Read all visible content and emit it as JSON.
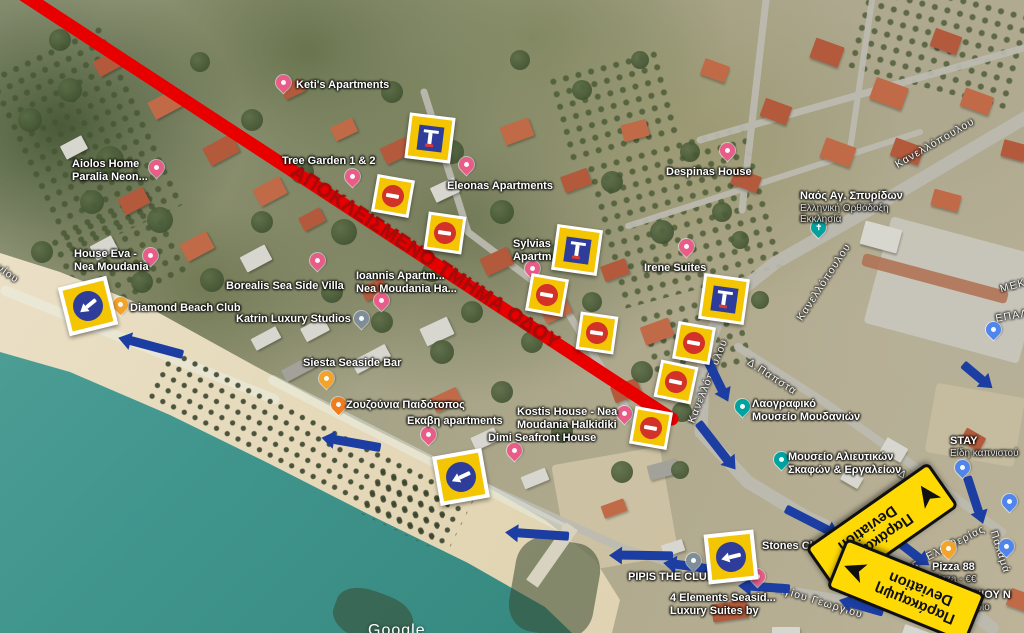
{
  "map": {
    "closed_road_text": "ΑΠΟΚΛΕΙΣΜΕΝΟ ΤΜΗΜΑ ΟΔΟΥ",
    "watermark": "Google",
    "colors": {
      "closed_line": "#e80000",
      "closed_text": "#a50b0b",
      "sign_yellow": "#f3c503",
      "sign_blue": "#2e3d99",
      "no_entry_red": "#d23227",
      "detour_arrow": "#1c3ea2",
      "deviation_yellow": "#ffd903",
      "sea": "#3f948c"
    },
    "places": [
      {
        "name": "ketis-apartments",
        "lines": [
          "Keti's Apartments"
        ],
        "lx": 296,
        "ly": 79,
        "marker": {
          "type": "pink",
          "x": 283,
          "y": 90
        }
      },
      {
        "name": "aiolos-home",
        "lines": [
          "Aiolos Home",
          "Paralia Neon..."
        ],
        "lx": 72,
        "ly": 158,
        "marker": {
          "type": "pink",
          "x": 156,
          "y": 175
        }
      },
      {
        "name": "house-eva",
        "lines": [
          "House Eva -",
          "Nea Moudania"
        ],
        "lx": 74,
        "ly": 248,
        "marker": {
          "type": "pink",
          "x": 150,
          "y": 263
        }
      },
      {
        "name": "borealis-villa",
        "lines": [
          "Borealis Sea Side Villa"
        ],
        "lx": 226,
        "ly": 280,
        "marker": {
          "type": "pink",
          "x": 317,
          "y": 268
        }
      },
      {
        "name": "tree-garden",
        "lines": [
          "Tree Garden 1 & 2"
        ],
        "lx": 282,
        "ly": 155,
        "marker": {
          "type": "pink",
          "x": 352,
          "y": 184
        }
      },
      {
        "name": "eleonas-apartments",
        "lines": [
          "Eleonas Apartments"
        ],
        "lx": 447,
        "ly": 180,
        "marker": {
          "type": "pink",
          "x": 466,
          "y": 172
        }
      },
      {
        "name": "despinas-house",
        "lines": [
          "Despinas House"
        ],
        "lx": 666,
        "ly": 166,
        "marker": {
          "type": "pink",
          "x": 727,
          "y": 158
        }
      },
      {
        "name": "sylvias-apartments",
        "lines": [
          "Sylvias",
          "Apartm..."
        ],
        "lx": 513,
        "ly": 238,
        "marker": {
          "type": "pink",
          "x": 532,
          "y": 276
        }
      },
      {
        "name": "irene-suites",
        "lines": [
          "Irene Suites"
        ],
        "lx": 644,
        "ly": 262,
        "marker": {
          "type": "pink",
          "x": 686,
          "y": 254
        }
      },
      {
        "name": "ioannis-apartments",
        "lines": [
          "Ioannis Apartm...",
          "Nea Moudania Ha..."
        ],
        "lx": 356,
        "ly": 270,
        "marker": {
          "type": "pink",
          "x": 381,
          "y": 308
        }
      },
      {
        "name": "katrin-studios",
        "lines": [
          "Katrin Luxury Studios"
        ],
        "lx": 236,
        "ly": 313,
        "marker": {
          "type": "gray",
          "x": 361,
          "y": 326
        }
      },
      {
        "name": "diamond-beach-club",
        "lines": [
          "Diamond Beach Club"
        ],
        "lx": 130,
        "ly": 302,
        "marker": {
          "type": "yellow",
          "x": 120,
          "y": 312
        }
      },
      {
        "name": "siesta-seaside-bar",
        "lines": [
          "Siesta Seaside Bar"
        ],
        "lx": 303,
        "ly": 357,
        "marker": {
          "type": "yellow",
          "x": 326,
          "y": 386
        }
      },
      {
        "name": "zouzounia",
        "lines": [
          "Ζουζούνια Παιδότοπος"
        ],
        "lx": 346,
        "ly": 399,
        "marker": {
          "type": "orange",
          "x": 338,
          "y": 412
        }
      },
      {
        "name": "ekavi-apartments",
        "lines": [
          "Εκαβη apartments"
        ],
        "lx": 407,
        "ly": 415,
        "marker": {
          "type": "pink",
          "x": 428,
          "y": 442
        }
      },
      {
        "name": "kostis-house",
        "lines": [
          "Kostis House - Nea",
          "Moudania Halkidiki"
        ],
        "lx": 517,
        "ly": 406,
        "marker": {
          "type": "pink",
          "x": 624,
          "y": 421
        }
      },
      {
        "name": "dimi-seafront-house",
        "lines": [
          "Dimi Seafront House"
        ],
        "lx": 488,
        "ly": 432,
        "marker": {
          "type": "pink",
          "x": 514,
          "y": 458
        }
      },
      {
        "name": "four-elements",
        "lines": [
          "4 Elements Seasid...",
          "Luxury Suites by"
        ],
        "lx": 670,
        "ly": 592,
        "marker": {
          "type": "pink",
          "x": 757,
          "y": 584
        }
      },
      {
        "name": "pipis-the-club",
        "lines": [
          "PIPIS THE CLUB"
        ],
        "lx": 628,
        "ly": 571,
        "marker": {
          "type": "gray",
          "x": 693,
          "y": 568
        }
      },
      {
        "name": "stones-club",
        "lines": [
          "Stones Club"
        ],
        "lx": 762,
        "ly": 540,
        "marker": {
          "type": "yellow",
          "x": 831,
          "y": 550
        }
      },
      {
        "name": "pizza-88",
        "lines": [
          "Pizza 88"
        ],
        "subs": [
          "Pizza - €€"
        ],
        "lx": 932,
        "ly": 561,
        "marker": {
          "type": "yellow",
          "x": 948,
          "y": 556
        }
      },
      {
        "name": "laografiko-mouseio",
        "lines": [
          "Λαογραφικό",
          "Μουσείο Μουδανιών"
        ],
        "lx": 752,
        "ly": 398,
        "marker": {
          "type": "teal",
          "x": 742,
          "y": 414
        }
      },
      {
        "name": "mouseio-alieutikon",
        "lines": [
          "Μουσείο Αλιευτικών",
          "Σκαφών & Εργαλείων"
        ],
        "lx": 788,
        "ly": 451,
        "marker": {
          "type": "teal",
          "x": 781,
          "y": 467
        }
      },
      {
        "name": "naos-ag-spyridon",
        "lines": [
          "Ναός Αγ. Σπυρίδων"
        ],
        "subs": [
          "Ελληνική Ορθόδοξη",
          "Εκκλησία"
        ],
        "lx": 800,
        "ly": 190,
        "marker": {
          "type": "church",
          "x": 818,
          "y": 235,
          "glyph": "✝"
        }
      },
      {
        "name": "stay-shop",
        "lines": [
          "STAY"
        ],
        "subs": [
          "Είδη καπνιστού"
        ],
        "lx": 950,
        "ly": 435,
        "marker": {
          "type": "blue",
          "x": 962,
          "y": 475
        }
      },
      {
        "name": "antoniou",
        "lines": [
          "ΑΝΤΩΝΙΟΥ Ν"
        ],
        "subs": [
          "Εστιατόριο"
        ],
        "lx": 942,
        "ly": 589,
        "marker": null
      }
    ],
    "extra_markers": [
      {
        "name": "lodging-marker",
        "type": "blue",
        "x": 993,
        "y": 337
      },
      {
        "name": "shop-marker",
        "type": "blue",
        "x": 1009,
        "y": 509
      },
      {
        "name": "lodging-marker",
        "type": "blue",
        "x": 1006,
        "y": 554
      }
    ],
    "street_labels": [
      {
        "text": "Κανελλόπουλου",
        "x": 935,
        "y": 143,
        "rot": -30
      },
      {
        "text": "Κανελλόπουλου",
        "x": 824,
        "y": 282,
        "rot": -57
      },
      {
        "text": "Κανελλόπουλου",
        "x": 708,
        "y": 381,
        "rot": -68
      },
      {
        "text": "Δ.Παπστα",
        "x": 772,
        "y": 377,
        "rot": 33
      },
      {
        "text": "Δ.Παπστα",
        "x": 923,
        "y": 488,
        "rot": 33
      },
      {
        "text": "Λεωφ. Ελευθερίας",
        "x": 938,
        "y": 552,
        "rot": -27
      },
      {
        "text": "Παλαμά",
        "x": 1000,
        "y": 552,
        "rot": 72
      },
      {
        "text": "Αγίου Γεωργίου",
        "x": 820,
        "y": 602,
        "rot": 17
      },
      {
        "text": "νίου",
        "x": 8,
        "y": 274,
        "rot": 35
      },
      {
        "text": "ΜΕΚ",
        "x": 1013,
        "y": 286,
        "rot": -15
      },
      {
        "text": "ΕΠΑΛ",
        "x": 1012,
        "y": 316,
        "rot": -10
      }
    ],
    "signs": {
      "no_entry": [
        {
          "x": 393,
          "y": 196,
          "rot": 10
        },
        {
          "x": 445,
          "y": 233,
          "rot": 8
        },
        {
          "x": 547,
          "y": 295,
          "rot": 10
        },
        {
          "x": 597,
          "y": 333,
          "rot": 8
        },
        {
          "x": 694,
          "y": 343,
          "rot": 10
        },
        {
          "x": 676,
          "y": 382,
          "rot": 12
        },
        {
          "x": 651,
          "y": 428,
          "rot": 10
        }
      ],
      "dead_end": [
        {
          "x": 430,
          "y": 138,
          "rot": 7
        },
        {
          "x": 577,
          "y": 250,
          "rot": 8
        },
        {
          "x": 724,
          "y": 299,
          "rot": 8
        }
      ],
      "turn_left": [
        {
          "x": 88,
          "y": 306,
          "rot": -14,
          "arrow": -25
        },
        {
          "x": 461,
          "y": 477,
          "rot": -10,
          "arrow": -15
        },
        {
          "x": 731,
          "y": 557,
          "rot": -6,
          "arrow": -8
        }
      ]
    },
    "deviation_signs": [
      {
        "line1": "Παράκαμψη",
        "line2": "Deviation",
        "x": 882,
        "y": 527,
        "rot": 145,
        "arrow_at": "start",
        "arrow_rot": 90
      },
      {
        "line1": "Παράκαμψη",
        "line2": "Deviation",
        "x": 906,
        "y": 591,
        "rot": 202,
        "arrow_at": "end",
        "arrow_rot": 0
      }
    ],
    "detour_arrows": [
      {
        "x": 156,
        "y": 347,
        "rot": 195,
        "len": 55
      },
      {
        "x": 357,
        "y": 443,
        "rot": 190,
        "len": 48
      },
      {
        "x": 543,
        "y": 534,
        "rot": 184,
        "len": 52
      },
      {
        "x": 647,
        "y": 555,
        "rot": 181,
        "len": 52
      },
      {
        "x": 692,
        "y": 566,
        "rot": 188,
        "len": 34
      },
      {
        "x": 770,
        "y": 587,
        "rot": 184,
        "len": 40
      },
      {
        "x": 867,
        "y": 607,
        "rot": 196,
        "len": 34
      },
      {
        "x": 903,
        "y": 545,
        "rot": 38,
        "len": 42
      },
      {
        "x": 712,
        "y": 369,
        "rot": 64,
        "len": 48
      },
      {
        "x": 713,
        "y": 441,
        "rot": 52,
        "len": 48
      },
      {
        "x": 807,
        "y": 519,
        "rot": 27,
        "len": 48
      },
      {
        "x": 973,
        "y": 372,
        "rot": 40,
        "len": 26
      },
      {
        "x": 973,
        "y": 494,
        "rot": 72,
        "len": 38
      }
    ]
  }
}
